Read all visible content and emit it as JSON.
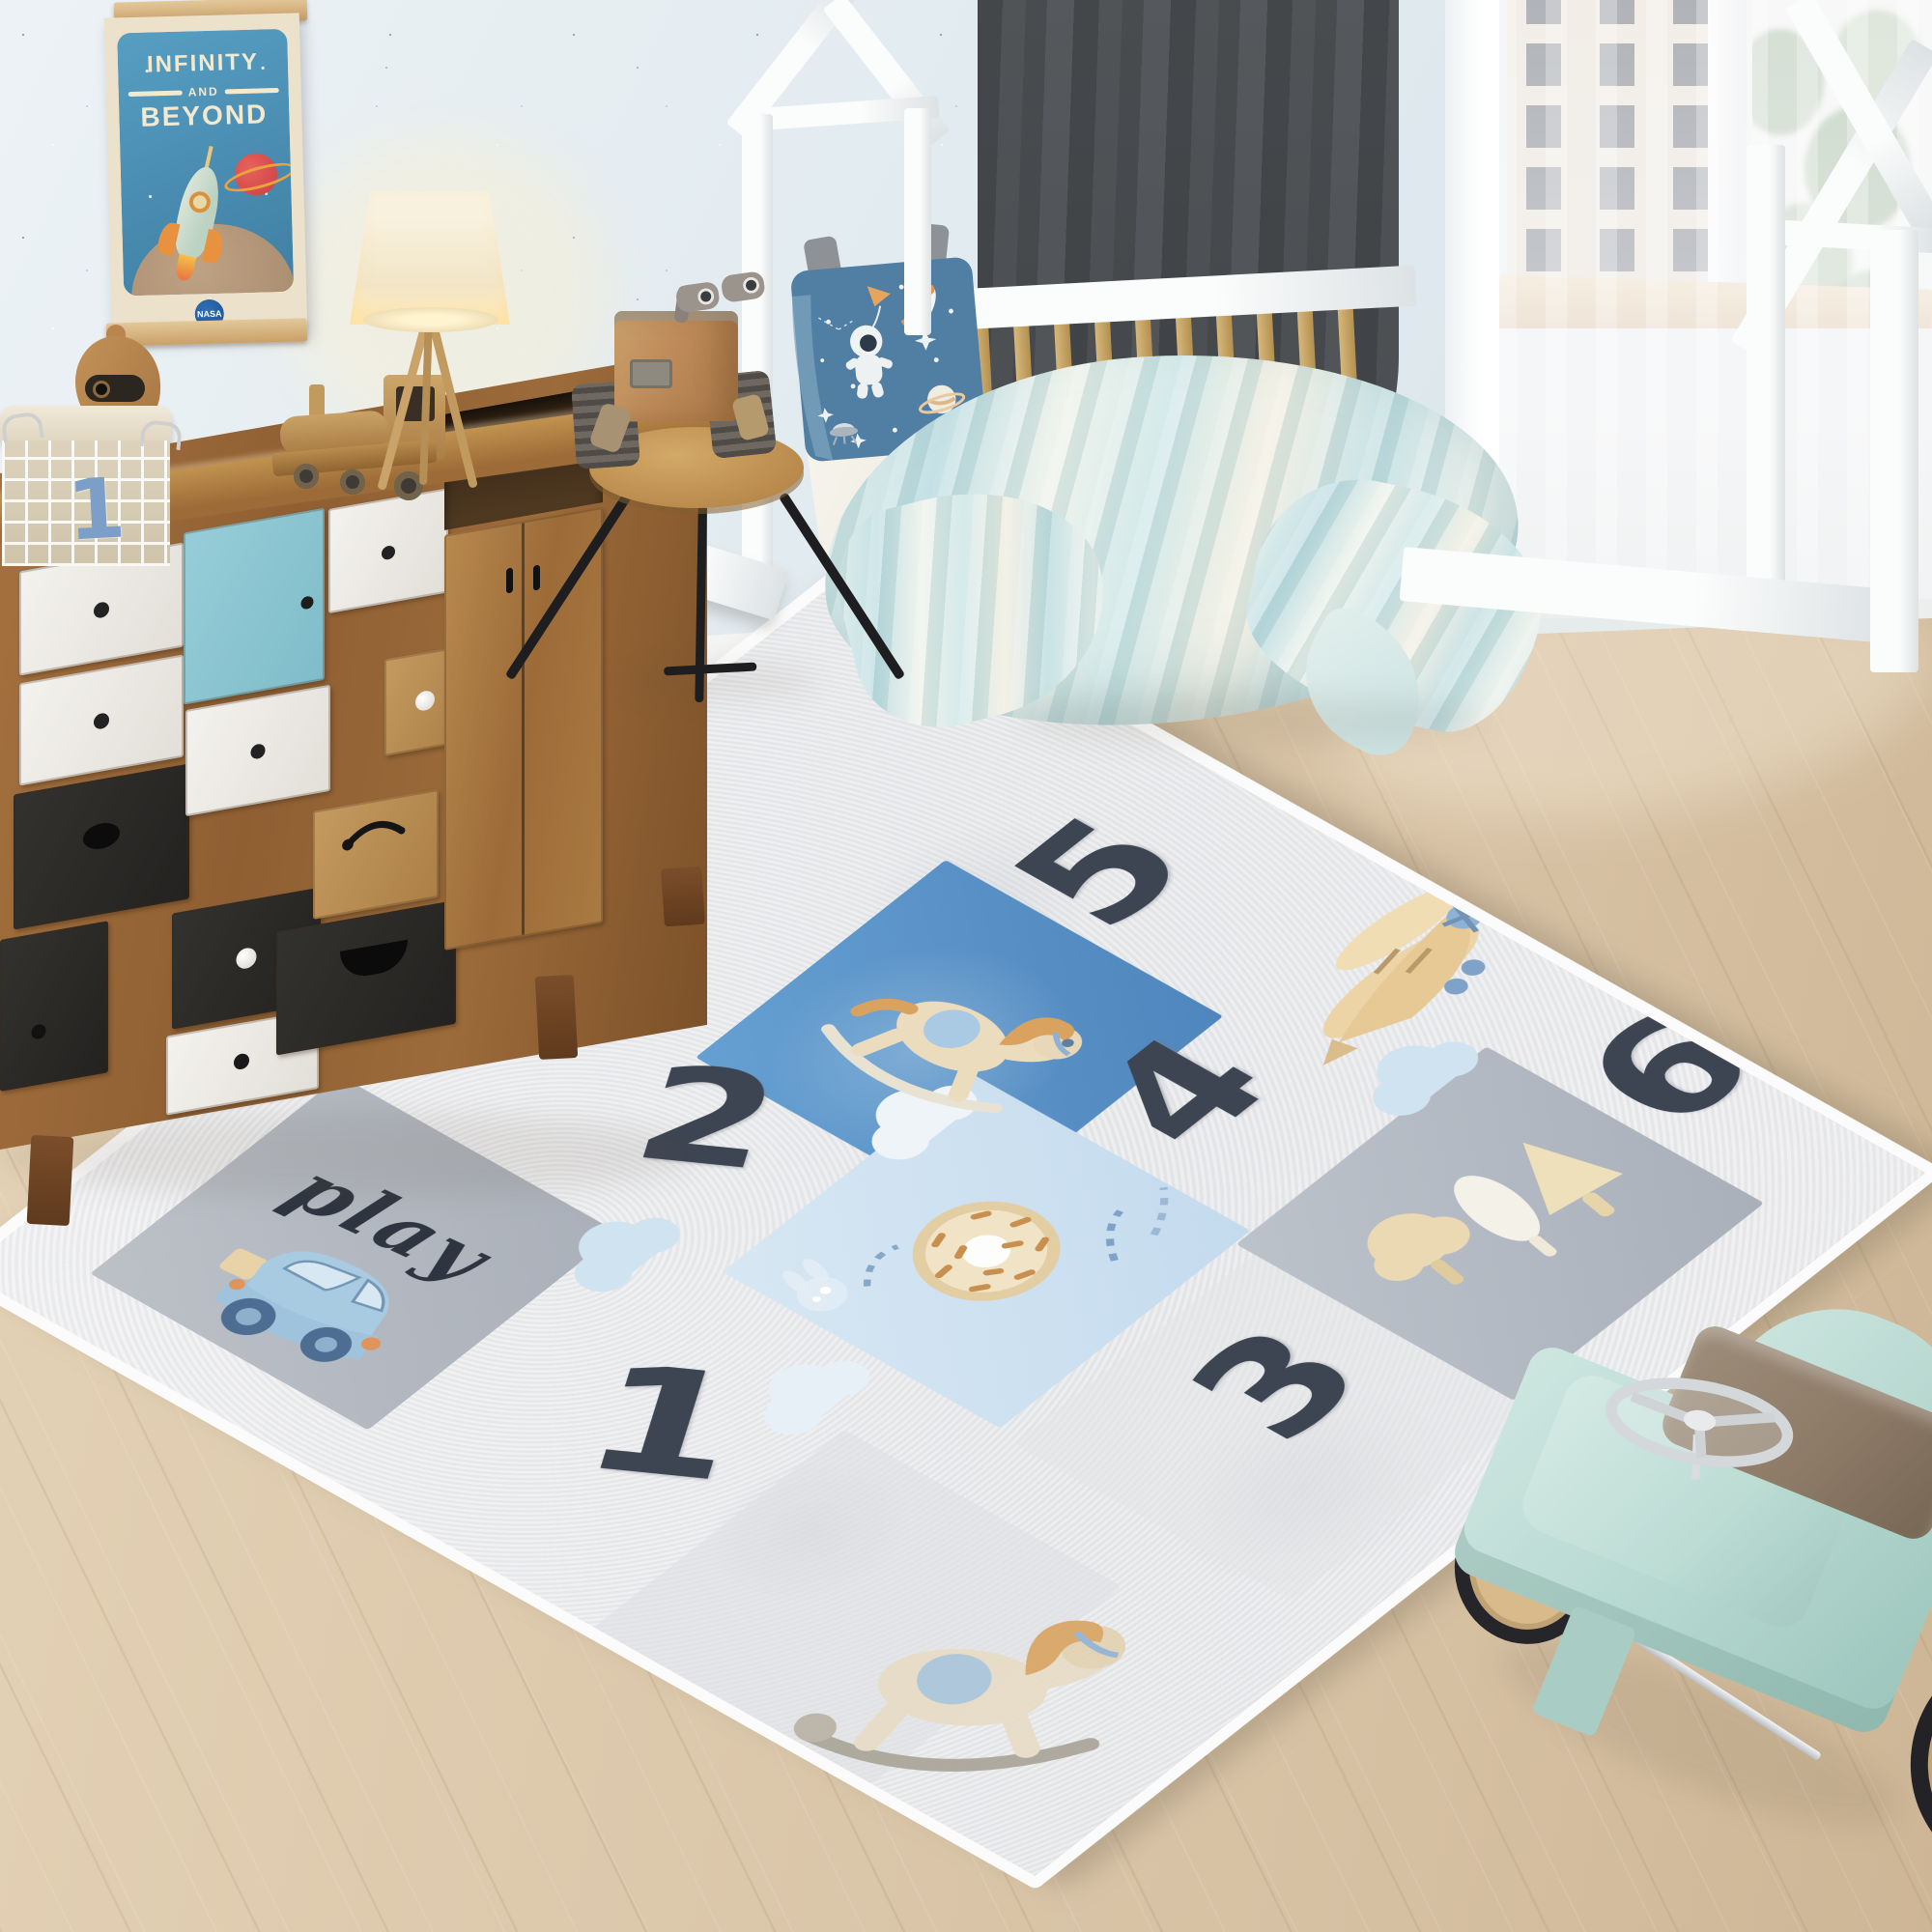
{
  "poster": {
    "line1": "INFINITY",
    "line2": "AND",
    "line3": "BEYOND",
    "logo": "NASA"
  },
  "basket": {
    "number": "1"
  },
  "rug": {
    "word": "play",
    "numbers": [
      "1",
      "2",
      "3",
      "4",
      "5",
      "6"
    ],
    "motifs": [
      "toy-car",
      "rocking-horse",
      "airplane",
      "donut",
      "trees",
      "clouds",
      "rocking-horse"
    ],
    "colors": {
      "base": "#ededef",
      "blue_square": "#5b93c9",
      "light_blue_square": "#cfe2f1",
      "gray_square": "#b5bac2",
      "numbers": "#3d4553",
      "binding": "#fbfbfb"
    }
  },
  "palette": {
    "wall": "#e2ebf0",
    "floor": "#ddc9ad",
    "wood": "#9a6b3f",
    "teal_door": "#8ec7d2",
    "curtain": "#8a8d90",
    "duvet": "#cde4e4",
    "pillow": "#517ea3",
    "mint_car": "#b7d8d2",
    "bed_frame": "#f4f5f4"
  }
}
